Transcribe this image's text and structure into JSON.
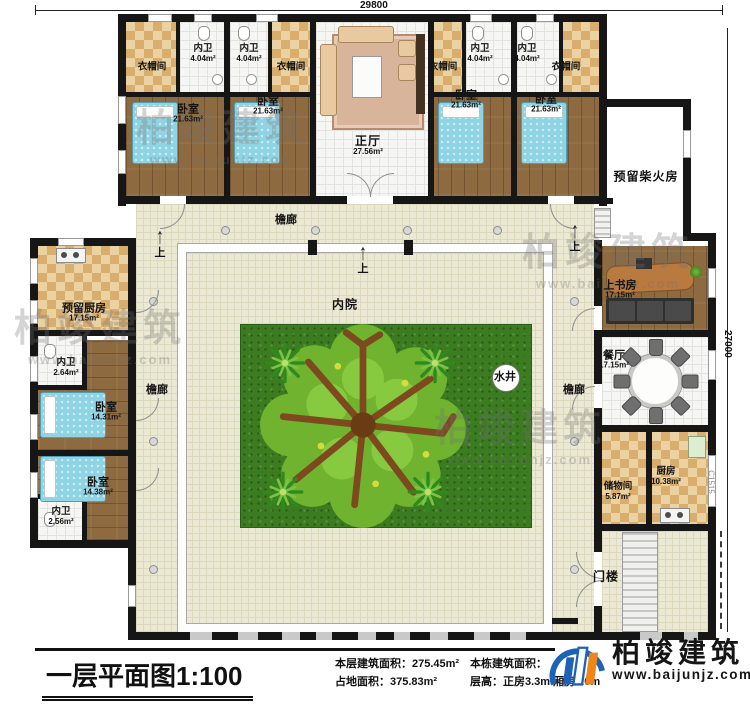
{
  "title_block": {
    "title": "一层平面图1:100",
    "floor_area_label": "本层建筑面积：",
    "floor_area_value": "275.45m²",
    "land_area_label": "占地面积：",
    "land_area_value": "375.83m²",
    "building_area_label": "本栋建筑面积：",
    "height_label": "层高：",
    "height_value": "正房3.3m 厢房3.0m"
  },
  "dimensions": {
    "top_width": "29800",
    "right_height": "27000",
    "window_code": "C1515"
  },
  "brand": {
    "name": "柏竣建筑",
    "website": "www.baijunjz.com"
  },
  "rooms": {
    "cloakroom": {
      "name": "衣帽间"
    },
    "bath_404": {
      "name": "内卫",
      "area": "4.04m²"
    },
    "bedroom_2163": {
      "name": "卧室",
      "area": "21.63m²"
    },
    "main_hall": {
      "name": "正厅",
      "area": "27.56m²"
    },
    "firewood": {
      "name": "预留柴火房"
    },
    "reserved_kitchen": {
      "name": "预留厨房",
      "area": "17.15m²"
    },
    "bath_264": {
      "name": "内卫",
      "area": "2.64m²"
    },
    "bedroom_1431": {
      "name": "卧室",
      "area": "14.31m²"
    },
    "bedroom_1438": {
      "name": "卧室",
      "area": "14.38m²"
    },
    "bath_256": {
      "name": "内卫",
      "area": "2.56m²"
    },
    "study": {
      "name": "上书房",
      "area": "17.15m²"
    },
    "dining": {
      "name": "餐厅",
      "area": "17.15m²"
    },
    "storage": {
      "name": "储物间",
      "area": "5.87m²"
    },
    "kitchen": {
      "name": "厨房",
      "area": "10.38m²"
    },
    "gate": {
      "name": "门楼"
    },
    "courtyard": {
      "name": "内院"
    },
    "well": {
      "name": "水井"
    },
    "veranda": {
      "name": "檐廊"
    },
    "step_up": {
      "name": "上"
    }
  }
}
